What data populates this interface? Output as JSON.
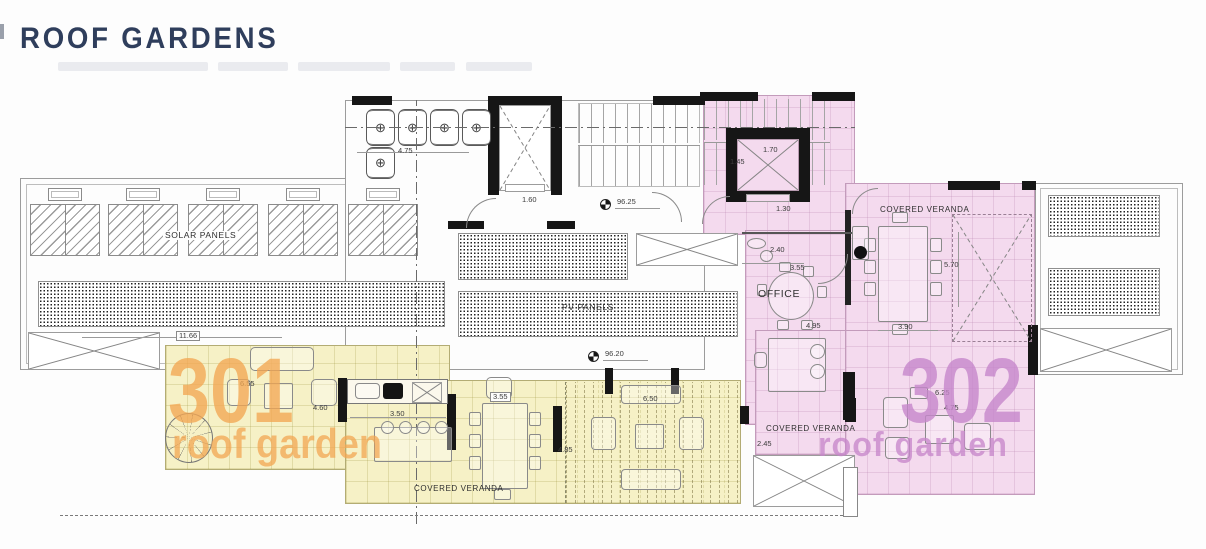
{
  "header": {
    "title": "ROOF GARDENS"
  },
  "labels": {
    "solar_panels": "SOLAR PANELS",
    "pv_panels": "PV PANELS",
    "office": "OFFICE",
    "covered_veranda": "COVERED VERANDA"
  },
  "units": {
    "u301": {
      "number": "301",
      "name": "roof garden"
    },
    "u302": {
      "number": "302",
      "name": "roof garden"
    }
  },
  "levels": {
    "upper": "96.25",
    "lower": "96.20"
  },
  "dims": {
    "tanks_width": "4.75",
    "lift_lobby": "1.60",
    "lift2_w": "1.70",
    "lift2_d": "1.45",
    "corridor": "1.30",
    "wc": "2.40",
    "office_w": "3.55",
    "office_d": "4.95",
    "veranda_tr_d": "5.70",
    "veranda_tr_w": "3.90",
    "terrace_301_w": "11.66",
    "terrace_301_a": "6.55",
    "terrace_301_b": "4.60",
    "kitchen_w": "3.50",
    "veranda_table": "3.55",
    "veranda_mid": "6.50",
    "veranda_d": "4.85",
    "terrace_302_a": "6.25",
    "terrace_302_b": "4.75",
    "veranda_bl": "2.45"
  },
  "colors": {
    "title": "#2f3e5c",
    "accent_301": "#f2a652",
    "accent_302": "#c686ca",
    "fill_301": "#f6f1c6",
    "fill_302": "#f4daee",
    "wall": "#161616"
  }
}
